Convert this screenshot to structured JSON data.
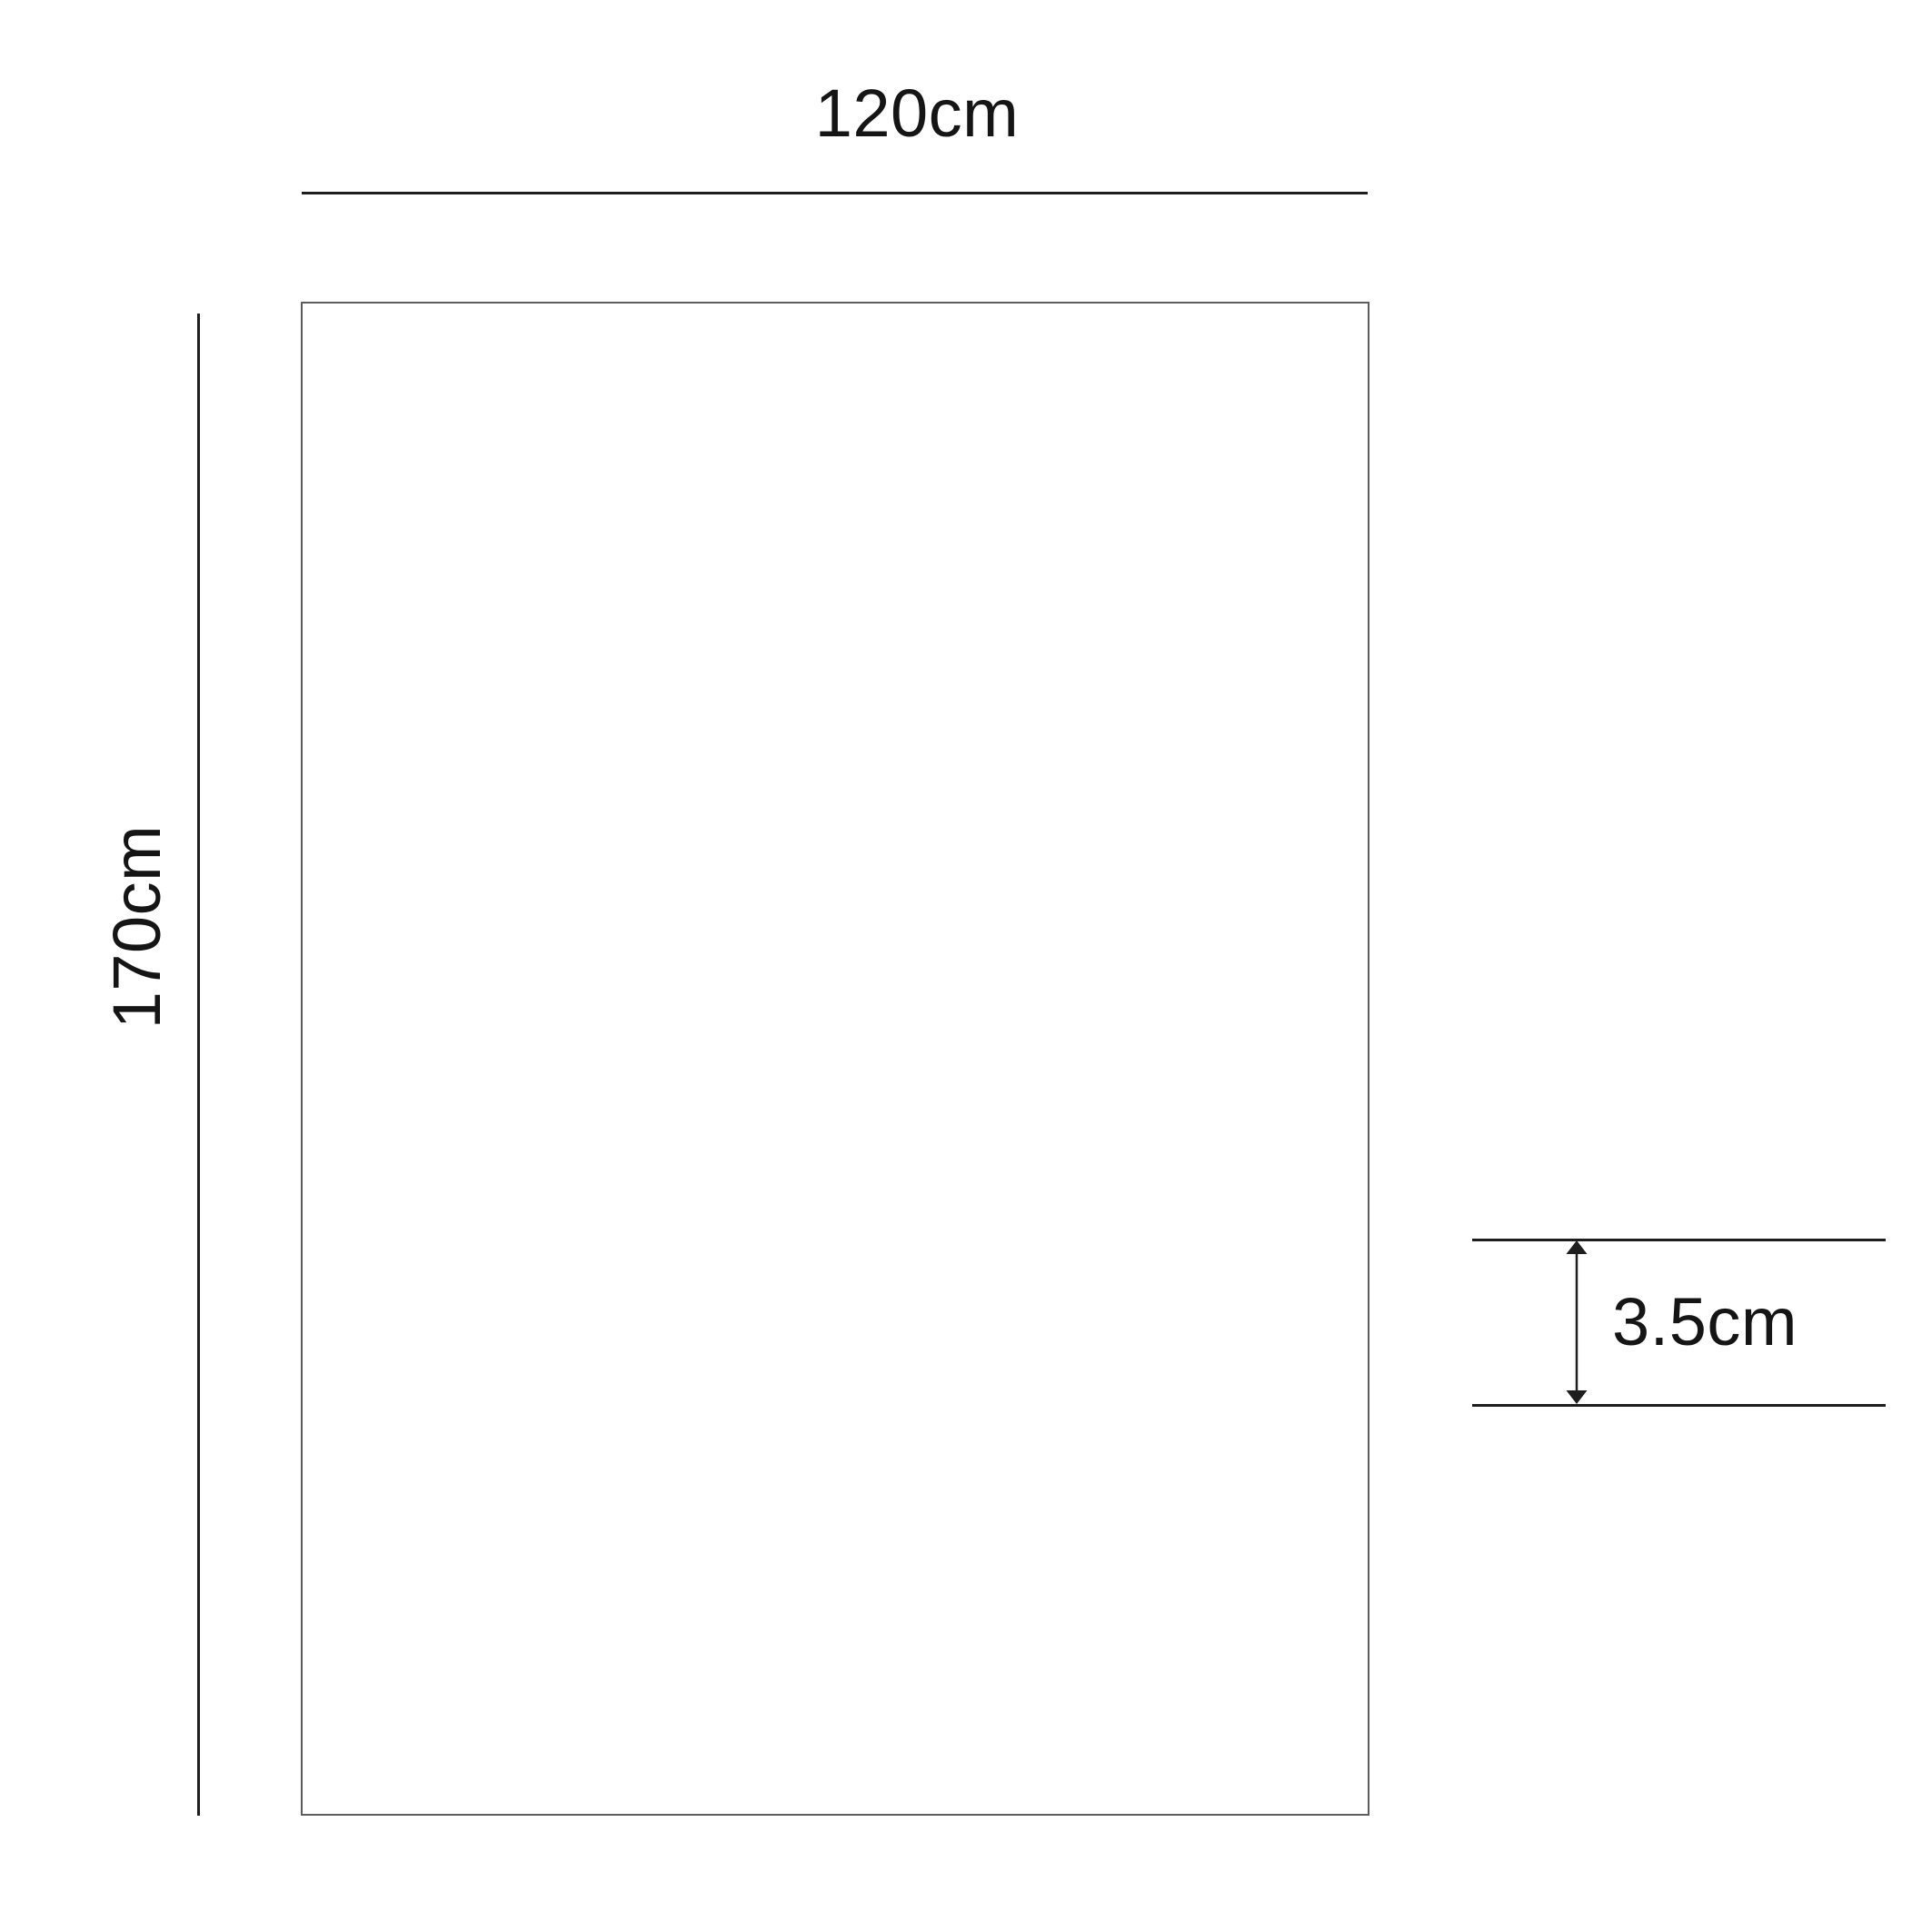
{
  "diagram": {
    "type": "dimension-drawing",
    "shape": "rectangular panel",
    "dimensions": {
      "width": {
        "label": "120cm",
        "value_cm": 120
      },
      "height": {
        "label": "170cm",
        "value_cm": 170
      },
      "thickness": {
        "label": "3.5cm",
        "value_cm": 3.5
      }
    },
    "colors": {
      "background": "#ffffff",
      "dimension_line": "#1e1e1e",
      "panel_border": "#5d5d5d",
      "text": "#151515"
    }
  }
}
